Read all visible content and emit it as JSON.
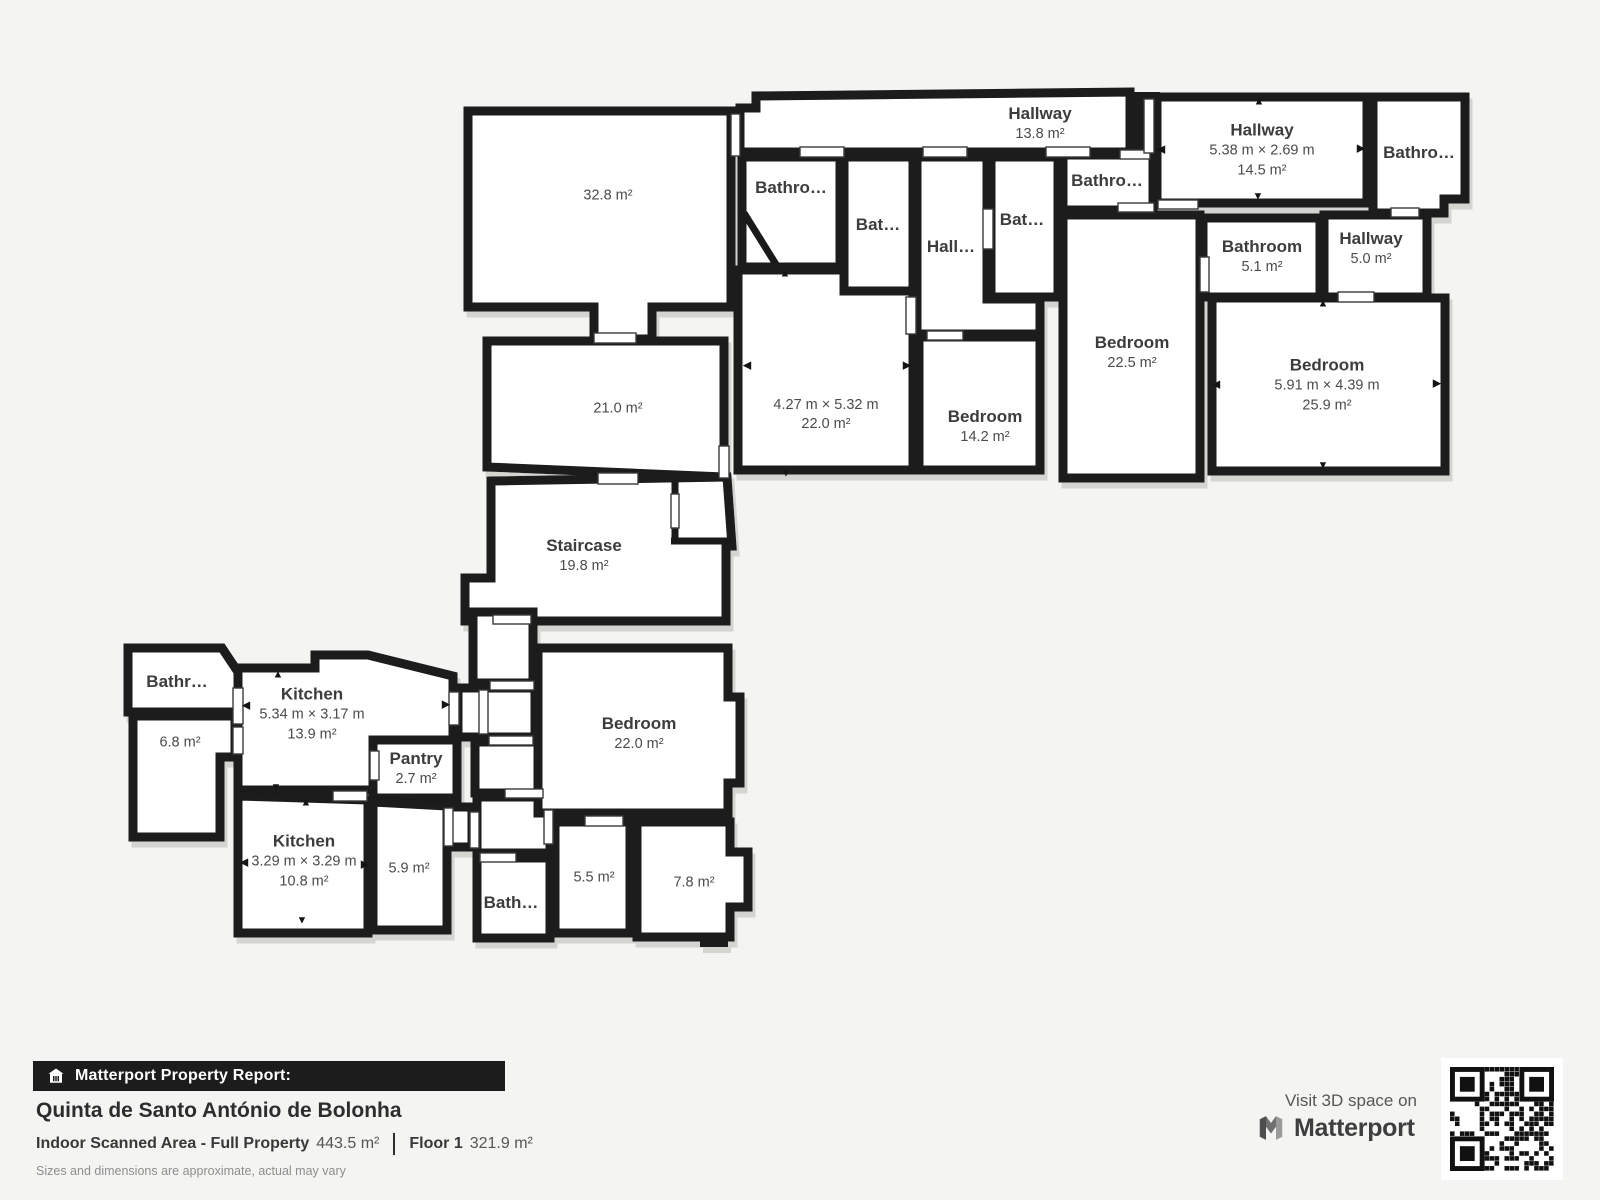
{
  "colors": {
    "wall": "#1a1a1a",
    "room_fill": "#ffffff",
    "background": "#f4f4f2",
    "bar_bg": "#1c1c1c"
  },
  "icons": {
    "arrow_up": "▲",
    "arrow_down": "▼",
    "arrow_left": "◀",
    "arrow_right": "▶",
    "house": "house-icon",
    "qr": "qr-code"
  },
  "rooms": [
    {
      "area": "32.8 m²"
    },
    {
      "area": "21.0 m²"
    },
    {
      "name": "Hallway",
      "area": "13.8 m²"
    },
    {
      "name": "Bathro…"
    },
    {
      "name": "Bat…"
    },
    {
      "name": "Hall…"
    },
    {
      "name": "Bat…"
    },
    {
      "name": "Bathro…"
    },
    {
      "name": "Hallway",
      "dims": "5.38 m × 2.69 m",
      "area": "14.5 m²"
    },
    {
      "name": "Bathro…"
    },
    {
      "name": "Bathroom",
      "area": "5.1 m²"
    },
    {
      "name": "Hallway",
      "area": "5.0 m²"
    },
    {
      "name": "Bedroom",
      "area": "22.5 m²"
    },
    {
      "name": "Bedroom",
      "dims": "5.91 m × 4.39 m",
      "area": "25.9 m²"
    },
    {
      "dims": "4.27 m × 5.32 m",
      "area": "22.0 m²"
    },
    {
      "name": "Bedroom",
      "area": "14.2 m²"
    },
    {
      "name": "Staircase",
      "area": "19.8 m²"
    },
    {
      "name": "Bathr…"
    },
    {
      "area": "6.8 m²"
    },
    {
      "name": "Kitchen",
      "dims": "5.34 m × 3.17 m",
      "area": "13.9 m²"
    },
    {
      "name": "Pantry",
      "area": "2.7 m²"
    },
    {
      "name": "Bedroom",
      "area": "22.0 m²"
    },
    {
      "name": "Kitchen",
      "dims": "3.29 m × 3.29 m",
      "area": "10.8 m²"
    },
    {
      "area": "5.9 m²"
    },
    {
      "name": "Bath…"
    },
    {
      "area": "5.5 m²"
    },
    {
      "area": "7.8 m²"
    }
  ],
  "footer": {
    "report_label": "Matterport Property Report:",
    "property_name": "Quinta de Santo António de Bolonha",
    "area_label": "Indoor Scanned Area - Full Property",
    "area_value": "443.5 m²",
    "floor_label": "Floor 1",
    "floor_value": "321.9 m²",
    "disclaimer": "Sizes and dimensions are approximate, actual may vary",
    "visit_label": "Visit 3D space on",
    "brand": "Matterport"
  }
}
